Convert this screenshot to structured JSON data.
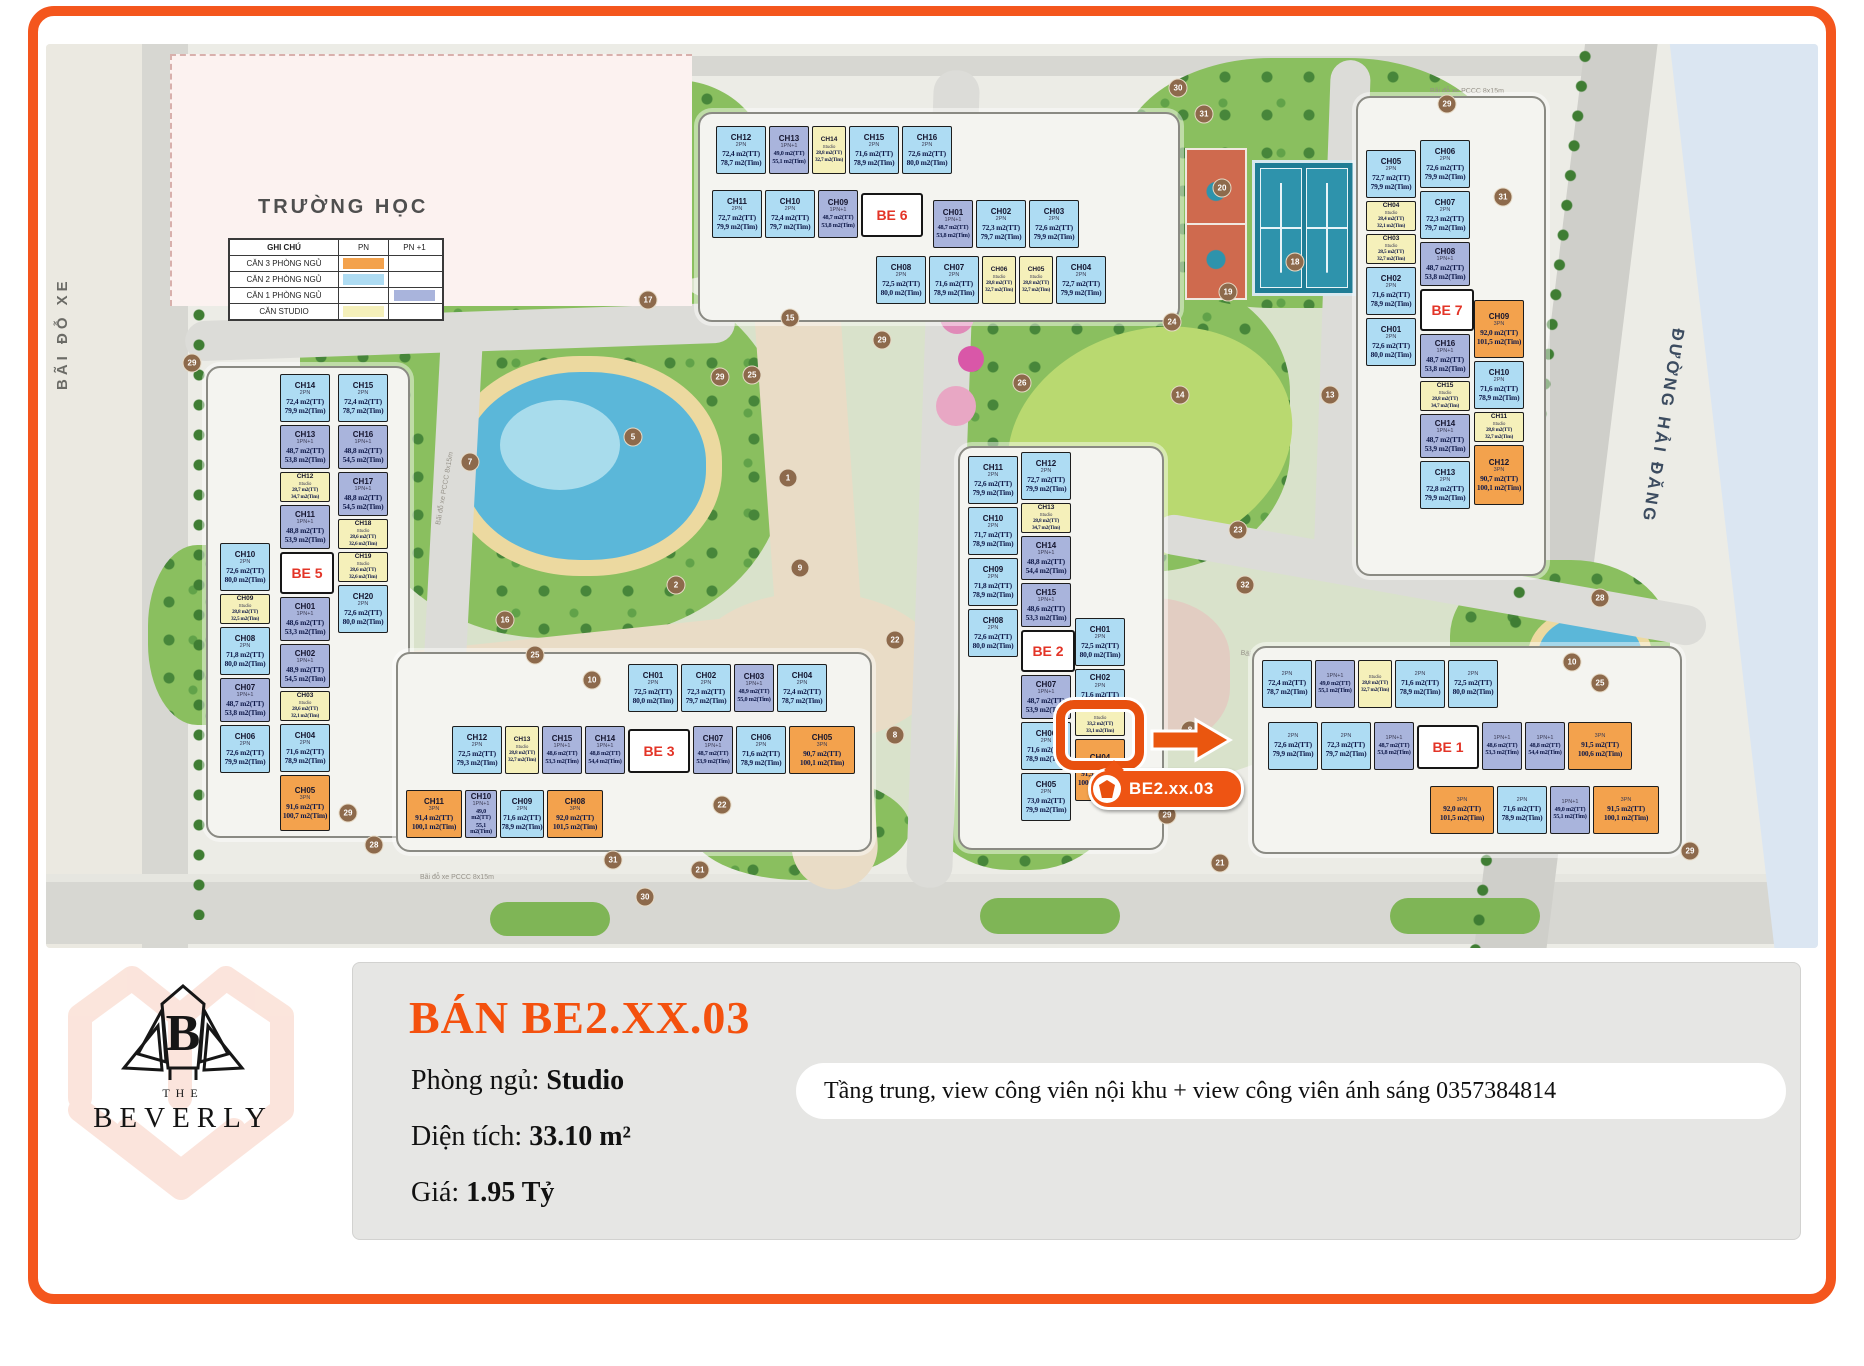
{
  "frame": {
    "border_color": "#f4561d"
  },
  "map": {
    "school_label": "TRƯỜNG HỌC",
    "parking_label": "BÃI ĐỖ XE",
    "street_label": "ĐƯỜNG HẢI ĐĂNG",
    "pccc_label": "Bãi đỗ xe PCCC 8x15m",
    "legend": {
      "header": [
        "GHI CHÚ",
        "PN",
        "PN +1"
      ],
      "rows": [
        {
          "label": "CĂN 3 PHÒNG NGỦ",
          "pn": "#f3a24d",
          "pn1": ""
        },
        {
          "label": "CĂN 2 PHÒNG NGỦ",
          "pn": "#aedcf3",
          "pn1": ""
        },
        {
          "label": "CĂN 1 PHÒNG NGỦ",
          "pn": "",
          "pn1": "#a9b4dc"
        },
        {
          "label": "CĂN STUDIO",
          "pn": "#f5f0ba",
          "pn1": ""
        }
      ]
    },
    "unit_type_colors": {
      "2PN": "#aedcf3",
      "1PN+1": "#a9b4dc",
      "Studio": "#f5f0ba",
      "3PN": "#f3a24d"
    },
    "stacks": {
      "be6_row1": [
        {
          "id": "CH12",
          "t": "2PN",
          "a1": "72,4 m2(TT)",
          "a2": "78,7 m2(Tim)"
        },
        {
          "id": "CH13",
          "t": "1PN+1",
          "a1": "49,0 m2(TT)",
          "a2": "55,1 m2(Tim)",
          "n": 1
        },
        {
          "id": "CH14",
          "t": "Studio",
          "a1": "28,8 m2(TT)",
          "a2": "32,7 m2(Tim)",
          "s": 1
        },
        {
          "id": "CH15",
          "t": "2PN",
          "a1": "71,6 m2(TT)",
          "a2": "78,9 m2(Tim)"
        },
        {
          "id": "CH16",
          "t": "2PN",
          "a1": "72,6 m2(TT)",
          "a2": "80,0 m2(Tim)"
        }
      ],
      "be6_row2l": [
        {
          "id": "CH11",
          "t": "2PN",
          "a1": "72,7 m2(TT)",
          "a2": "79,9 m2(Tim)"
        },
        {
          "id": "CH10",
          "t": "2PN",
          "a1": "72,4 m2(TT)",
          "a2": "79,7 m2(Tim)"
        },
        {
          "id": "CH09",
          "t": "1PN+1",
          "a1": "48,7 m2(TT)",
          "a2": "53,8 m2(Tim)",
          "n": 1
        },
        {
          "be": "BE 6"
        }
      ],
      "be6_row2r": [
        {
          "id": "CH01",
          "t": "1PN+1",
          "a1": "48,7 m2(TT)",
          "a2": "53,8 m2(Tim)",
          "n": 1
        },
        {
          "id": "CH02",
          "t": "2PN",
          "a1": "72,3 m2(TT)",
          "a2": "79,7 m2(Tim)"
        },
        {
          "id": "CH03",
          "t": "2PN",
          "a1": "72,6 m2(TT)",
          "a2": "79,9 m2(Tim)"
        }
      ],
      "be6_row3": [
        {
          "id": "CH08",
          "t": "2PN",
          "a1": "72,5 m2(TT)",
          "a2": "80,0 m2(Tim)"
        },
        {
          "id": "CH07",
          "t": "2PN",
          "a1": "71,6 m2(TT)",
          "a2": "78,9 m2(Tim)"
        },
        {
          "id": "CH06",
          "t": "Studio",
          "a1": "28,8 m2(TT)",
          "a2": "32,7 m2(Tim)",
          "s": 1
        },
        {
          "id": "CH05",
          "t": "Studio",
          "a1": "28,8 m2(TT)",
          "a2": "32,7 m2(Tim)",
          "s": 1
        },
        {
          "id": "CH04",
          "t": "2PN",
          "a1": "72,7 m2(TT)",
          "a2": "79,9 m2(Tim)"
        }
      ],
      "be7_colA": [
        {
          "id": "CH05",
          "t": "2PN",
          "a1": "72,7 m2(TT)",
          "a2": "79,9 m2(Tim)"
        },
        {
          "id": "CH04",
          "t": "Studio",
          "a1": "28,4 m2(TT)",
          "a2": "32,1 m2(Tim)",
          "s": 1
        },
        {
          "id": "CH03",
          "t": "Studio",
          "a1": "28,5 m2(TT)",
          "a2": "32,7 m2(Tim)",
          "s": 1
        },
        {
          "id": "CH02",
          "t": "2PN",
          "a1": "71,6 m2(TT)",
          "a2": "78,9 m2(Tim)"
        },
        {
          "id": "CH01",
          "t": "2PN",
          "a1": "72,6 m2(TT)",
          "a2": "80,0 m2(Tim)"
        }
      ],
      "be7_colB": [
        {
          "id": "CH06",
          "t": "2PN",
          "a1": "72,6 m2(TT)",
          "a2": "79,9 m2(Tim)"
        },
        {
          "id": "CH07",
          "t": "2PN",
          "a1": "72,3 m2(TT)",
          "a2": "79,7 m2(Tim)"
        },
        {
          "id": "CH08",
          "t": "1PN+1",
          "a1": "48,7 m2(TT)",
          "a2": "53,8 m2(Tim)"
        },
        {
          "be": "BE 7"
        },
        {
          "id": "CH16",
          "t": "1PN+1",
          "a1": "48,7 m2(TT)",
          "a2": "53,8 m2(Tim)"
        },
        {
          "id": "CH15",
          "t": "Studio",
          "a1": "28,8 m2(TT)",
          "a2": "34,7 m2(Tim)",
          "s": 1
        },
        {
          "id": "CH14",
          "t": "1PN+1",
          "a1": "48,7 m2(TT)",
          "a2": "53,9 m2(Tim)"
        },
        {
          "id": "CH13",
          "t": "2PN",
          "a1": "72,8 m2(TT)",
          "a2": "79,9 m2(Tim)"
        }
      ],
      "be7_colC": [
        {
          "id": "CH09",
          "t": "3PN",
          "a1": "92,0 m2(TT)",
          "a2": "101,5 m2(Tim)",
          "h": 58
        },
        {
          "id": "CH10",
          "t": "2PN",
          "a1": "71,6 m2(TT)",
          "a2": "78,9 m2(Tim)"
        },
        {
          "id": "CH11",
          "t": "Studio",
          "a1": "28,8 m2(TT)",
          "a2": "32,7 m2(Tim)",
          "s": 1
        },
        {
          "id": "CH12",
          "t": "3PN",
          "a1": "90,7 m2(TT)",
          "a2": "100,1 m2(Tim)",
          "h": 60
        }
      ],
      "be5_colA": [
        {
          "id": "CH10",
          "t": "2PN",
          "a1": "72,6 m2(TT)",
          "a2": "80,0 m2(Tim)"
        },
        {
          "id": "CH09",
          "t": "Studio",
          "a1": "28,8 m2(TT)",
          "a2": "32,5 m2(Tim)",
          "s": 1
        },
        {
          "id": "CH08",
          "t": "2PN",
          "a1": "71,8 m2(TT)",
          "a2": "80,0 m2(Tim)"
        },
        {
          "id": "CH07",
          "t": "1PN+1",
          "a1": "48,7 m2(TT)",
          "a2": "53,8 m2(Tim)"
        },
        {
          "id": "CH06",
          "t": "2PN",
          "a1": "72,6 m2(TT)",
          "a2": "79,9 m2(Tim)"
        }
      ],
      "be5_colB": [
        {
          "id": "CH14",
          "t": "2PN",
          "a1": "72,4 m2(TT)",
          "a2": "79,9 m2(Tim)"
        },
        {
          "id": "CH13",
          "t": "1PN+1",
          "a1": "48,7 m2(TT)",
          "a2": "53,8 m2(Tim)"
        },
        {
          "id": "CH12",
          "t": "Studio",
          "a1": "28,7 m2(TT)",
          "a2": "34,7 m2(Tim)",
          "s": 1
        },
        {
          "id": "CH11",
          "t": "1PN+1",
          "a1": "48,8 m2(TT)",
          "a2": "53,9 m2(Tim)"
        },
        {
          "be": "BE 5"
        },
        {
          "id": "CH01",
          "t": "1PN+1",
          "a1": "48,6 m2(TT)",
          "a2": "53,3 m2(Tim)"
        },
        {
          "id": "CH02",
          "t": "1PN+1",
          "a1": "48,9 m2(TT)",
          "a2": "54,5 m2(Tim)"
        },
        {
          "id": "CH03",
          "t": "Studio",
          "a1": "28,6 m2(TT)",
          "a2": "32,1 m2(Tim)",
          "s": 1
        },
        {
          "id": "CH04",
          "t": "2PN",
          "a1": "71,6 m2(TT)",
          "a2": "78,9 m2(Tim)"
        },
        {
          "id": "CH05",
          "t": "3PN",
          "a1": "91,6 m2(TT)",
          "a2": "100,7 m2(Tim)",
          "h": 56
        }
      ],
      "be5_colC": [
        {
          "id": "CH15",
          "t": "2PN",
          "a1": "72,4 m2(TT)",
          "a2": "78,7 m2(Tim)"
        },
        {
          "id": "CH16",
          "t": "1PN+1",
          "a1": "48,8 m2(TT)",
          "a2": "54,5 m2(Tim)"
        },
        {
          "id": "CH17",
          "t": "1PN+1",
          "a1": "48,8 m2(TT)",
          "a2": "54,5 m2(Tim)"
        },
        {
          "id": "CH18",
          "t": "Studio",
          "a1": "28,6 m2(TT)",
          "a2": "32,6 m2(Tim)",
          "s": 1
        },
        {
          "id": "CH19",
          "t": "Studio",
          "a1": "28,6 m2(TT)",
          "a2": "32,6 m2(Tim)",
          "s": 1
        },
        {
          "id": "CH20",
          "t": "2PN",
          "a1": "72,6 m2(TT)",
          "a2": "80,0 m2(Tim)"
        }
      ],
      "be2_colA": [
        {
          "id": "CH11",
          "t": "2PN",
          "a1": "72,6 m2(TT)",
          "a2": "79,9 m2(Tim)"
        },
        {
          "id": "CH10",
          "t": "2PN",
          "a1": "71,7 m2(TT)",
          "a2": "78,9 m2(Tim)"
        },
        {
          "id": "CH09",
          "t": "2PN",
          "a1": "71,8 m2(TT)",
          "a2": "78,9 m2(Tim)"
        },
        {
          "id": "CH08",
          "t": "2PN",
          "a1": "72,6 m2(TT)",
          "a2": "80,0 m2(Tim)"
        }
      ],
      "be2_colB": [
        {
          "id": "CH12",
          "t": "2PN",
          "a1": "72,7 m2(TT)",
          "a2": "79,9 m2(Tim)"
        },
        {
          "id": "CH13",
          "t": "Studio",
          "a1": "28,8 m2(TT)",
          "a2": "34,7 m2(Tim)",
          "s": 1
        },
        {
          "id": "CH14",
          "t": "1PN+1",
          "a1": "48,8 m2(TT)",
          "a2": "54,4 m2(Tim)"
        },
        {
          "id": "CH15",
          "t": "1PN+1",
          "a1": "48,6 m2(TT)",
          "a2": "53,3 m2(Tim)"
        },
        {
          "be": "BE 2"
        },
        {
          "id": "CH07",
          "t": "1PN+1",
          "a1": "48,7 m2(TT)",
          "a2": "53,9 m2(Tim)"
        },
        {
          "id": "CH06",
          "t": "2PN",
          "a1": "71,6 m2(TT)",
          "a2": "78,9 m2(Tim)"
        },
        {
          "id": "CH05",
          "t": "2PN",
          "a1": "73,0 m2(TT)",
          "a2": "79,9 m2(Tim)"
        }
      ],
      "be2_colC": [
        {
          "id": "CH01",
          "t": "2PN",
          "a1": "72,5 m2(TT)",
          "a2": "80,0 m2(Tim)"
        },
        {
          "id": "CH02",
          "t": "2PN",
          "a1": "71,6 m2(TT)",
          "h": 34
        },
        {
          "id": "CH03",
          "t": "Studio",
          "a1": "33,2 m2(TT)",
          "a2": "33,1 m2(Tim)",
          "s": 1,
          "hl": 1
        },
        {
          "id": "CH04",
          "t": "3PN",
          "a1": "91,5 m2(TT)",
          "a2": "100,6 m2(Tim)",
          "h": 62
        }
      ],
      "be3_row1": [
        {
          "id": "CH01",
          "t": "2PN",
          "a1": "72,5 m2(TT)",
          "a2": "80,0 m2(Tim)"
        },
        {
          "id": "CH02",
          "t": "2PN",
          "a1": "72,3 m2(TT)",
          "a2": "79,7 m2(Tim)"
        },
        {
          "id": "CH03",
          "t": "1PN+1",
          "a1": "48,9 m2(TT)",
          "a2": "55,0 m2(Tim)",
          "n": 1
        },
        {
          "id": "CH04",
          "t": "2PN",
          "a1": "72,4 m2(TT)",
          "a2": "78,7 m2(Tim)"
        }
      ],
      "be3_row2": [
        {
          "id": "CH12",
          "t": "2PN",
          "a1": "72,5 m2(TT)",
          "a2": "79,3 m2(Tim)"
        },
        {
          "id": "CH13",
          "t": "Studio",
          "a1": "28,8 m2(TT)",
          "a2": "32,7 m2(Tim)",
          "s": 1
        },
        {
          "id": "CH15",
          "t": "1PN+1",
          "a1": "48,6 m2(TT)",
          "a2": "53,3 m2(Tim)",
          "n": 1
        },
        {
          "id": "CH14",
          "t": "1PN+1",
          "a1": "48,8 m2(TT)",
          "a2": "54,4 m2(Tim)",
          "n": 1
        },
        {
          "be": "BE 3"
        },
        {
          "id": "CH07",
          "t": "1PN+1",
          "a1": "48,7 m2(TT)",
          "a2": "53,9 m2(Tim)",
          "n": 1
        },
        {
          "id": "CH06",
          "t": "2PN",
          "a1": "71,6 m2(TT)",
          "a2": "78,9 m2(Tim)"
        },
        {
          "id": "CH05",
          "t": "3PN",
          "a1": "90,7 m2(TT)",
          "a2": "100,1 m2(Tim)",
          "w": 66
        }
      ],
      "be3_row3": [
        {
          "id": "CH11",
          "t": "3PN",
          "a1": "91,4 m2(TT)",
          "a2": "100,1 m2(Tim)",
          "w": 56
        },
        {
          "id": "CH10",
          "t": "1PN+1",
          "a1": "49,0 m2(TT)",
          "a2": "55,1 m2(Tim)",
          "n": 1,
          "w": 32
        },
        {
          "id": "CH09",
          "t": "2PN",
          "a1": "71,6 m2(TT)",
          "a2": "78,9 m2(Tim)",
          "w": 44
        },
        {
          "id": "CH08",
          "t": "3PN",
          "a1": "92,0 m2(TT)",
          "a2": "101,5 m2(Tim)",
          "w": 56
        }
      ],
      "be1_row1": [
        {
          "t": "2PN",
          "a1": "72,4 m2(TT)",
          "a2": "78,7 m2(Tim)"
        },
        {
          "t": "1PN+1",
          "a1": "49,0 m2(TT)",
          "a2": "55,1 m2(Tim)",
          "n": 1
        },
        {
          "t": "Studio",
          "a1": "28,8 m2(TT)",
          "a2": "32,7 m2(Tim)",
          "s": 1
        },
        {
          "t": "2PN",
          "a1": "71,6 m2(TT)",
          "a2": "78,9 m2(Tim)"
        },
        {
          "t": "2PN",
          "a1": "72,5 m2(TT)",
          "a2": "80,0 m2(Tim)"
        }
      ],
      "be1_row2": [
        {
          "t": "2PN",
          "a1": "72,6 m2(TT)",
          "a2": "79,9 m2(Tim)"
        },
        {
          "t": "2PN",
          "a1": "72,3 m2(TT)",
          "a2": "79,7 m2(Tim)"
        },
        {
          "t": "1PN+1",
          "a1": "48,7 m2(TT)",
          "a2": "53,8 m2(Tim)",
          "n": 1
        },
        {
          "be": "BE 1"
        },
        {
          "t": "1PN+1",
          "a1": "48,6 m2(TT)",
          "a2": "53,3 m2(Tim)",
          "n": 1
        },
        {
          "t": "1PN+1",
          "a1": "48,8 m2(TT)",
          "a2": "54,4 m2(Tim)",
          "n": 1
        },
        {
          "t": "3PN",
          "a1": "91,5 m2(TT)",
          "a2": "100,6 m2(Tim)",
          "w": 64
        }
      ],
      "be1_row3": [
        {
          "t": "3PN",
          "a1": "92,0 m2(TT)",
          "a2": "101,5 m2(Tim)",
          "w": 64
        },
        {
          "t": "2PN",
          "a1": "71,6 m2(TT)",
          "a2": "78,9 m2(Tim)"
        },
        {
          "t": "1PN+1",
          "a1": "49,0 m2(TT)",
          "a2": "55,1 m2(Tim)",
          "n": 1
        },
        {
          "t": "3PN",
          "a1": "91,5 m2(TT)",
          "a2": "100,1 m2(Tim)",
          "w": 66
        }
      ]
    },
    "markers": [
      {
        "n": "1",
        "x": 788,
        "y": 478
      },
      {
        "n": "2",
        "x": 676,
        "y": 585
      },
      {
        "n": "5",
        "x": 633,
        "y": 437
      },
      {
        "n": "7",
        "x": 470,
        "y": 462
      },
      {
        "n": "9",
        "x": 800,
        "y": 568
      },
      {
        "n": "15",
        "x": 790,
        "y": 318
      },
      {
        "n": "16",
        "x": 505,
        "y": 620
      },
      {
        "n": "17",
        "x": 648,
        "y": 300
      },
      {
        "n": "25",
        "x": 752,
        "y": 375
      },
      {
        "n": "25",
        "x": 535,
        "y": 655
      },
      {
        "n": "25",
        "x": 1600,
        "y": 683
      },
      {
        "n": "26",
        "x": 1022,
        "y": 383
      },
      {
        "n": "8",
        "x": 1190,
        "y": 730
      },
      {
        "n": "8",
        "x": 895,
        "y": 735
      },
      {
        "n": "10",
        "x": 592,
        "y": 680
      },
      {
        "n": "10",
        "x": 1572,
        "y": 662
      },
      {
        "n": "22",
        "x": 722,
        "y": 805
      },
      {
        "n": "22",
        "x": 895,
        "y": 640
      },
      {
        "n": "23",
        "x": 1238,
        "y": 530
      },
      {
        "n": "24",
        "x": 1172,
        "y": 322
      },
      {
        "n": "18",
        "x": 1295,
        "y": 262
      },
      {
        "n": "19",
        "x": 1228,
        "y": 292
      },
      {
        "n": "20",
        "x": 1222,
        "y": 188
      },
      {
        "n": "14",
        "x": 1180,
        "y": 395
      },
      {
        "n": "13",
        "x": 1330,
        "y": 395
      },
      {
        "n": "32",
        "x": 1245,
        "y": 585
      },
      {
        "n": "29",
        "x": 882,
        "y": 340
      },
      {
        "n": "29",
        "x": 720,
        "y": 377
      },
      {
        "n": "29",
        "x": 348,
        "y": 813
      },
      {
        "n": "29",
        "x": 1167,
        "y": 815
      },
      {
        "n": "29",
        "x": 1447,
        "y": 104
      },
      {
        "n": "29",
        "x": 1690,
        "y": 851
      },
      {
        "n": "29",
        "x": 192,
        "y": 363
      },
      {
        "n": "28",
        "x": 374,
        "y": 845
      },
      {
        "n": "28",
        "x": 1600,
        "y": 598
      },
      {
        "n": "30",
        "x": 1178,
        "y": 88
      },
      {
        "n": "30",
        "x": 645,
        "y": 897
      },
      {
        "n": "31",
        "x": 1204,
        "y": 114
      },
      {
        "n": "31",
        "x": 1503,
        "y": 197
      },
      {
        "n": "31",
        "x": 613,
        "y": 860
      },
      {
        "n": "21",
        "x": 700,
        "y": 870
      },
      {
        "n": "21",
        "x": 1220,
        "y": 863
      }
    ]
  },
  "highlight": {
    "label": "BE2.xx.03"
  },
  "panel": {
    "title": "BÁN BE2.XX.03",
    "bedrooms_label": "Phòng ngủ:",
    "bedrooms_value": "Studio",
    "area_label": "Diện tích:",
    "area_value": "33.10 m²",
    "price_label": "Giá:",
    "price_value": "1.95 Tỷ",
    "note": "Tầng trung, view công viên nội khu + view công viên ánh sáng 0357384814"
  },
  "logo": {
    "monogram": "B",
    "the": "THE",
    "name": "BEVERLY"
  }
}
